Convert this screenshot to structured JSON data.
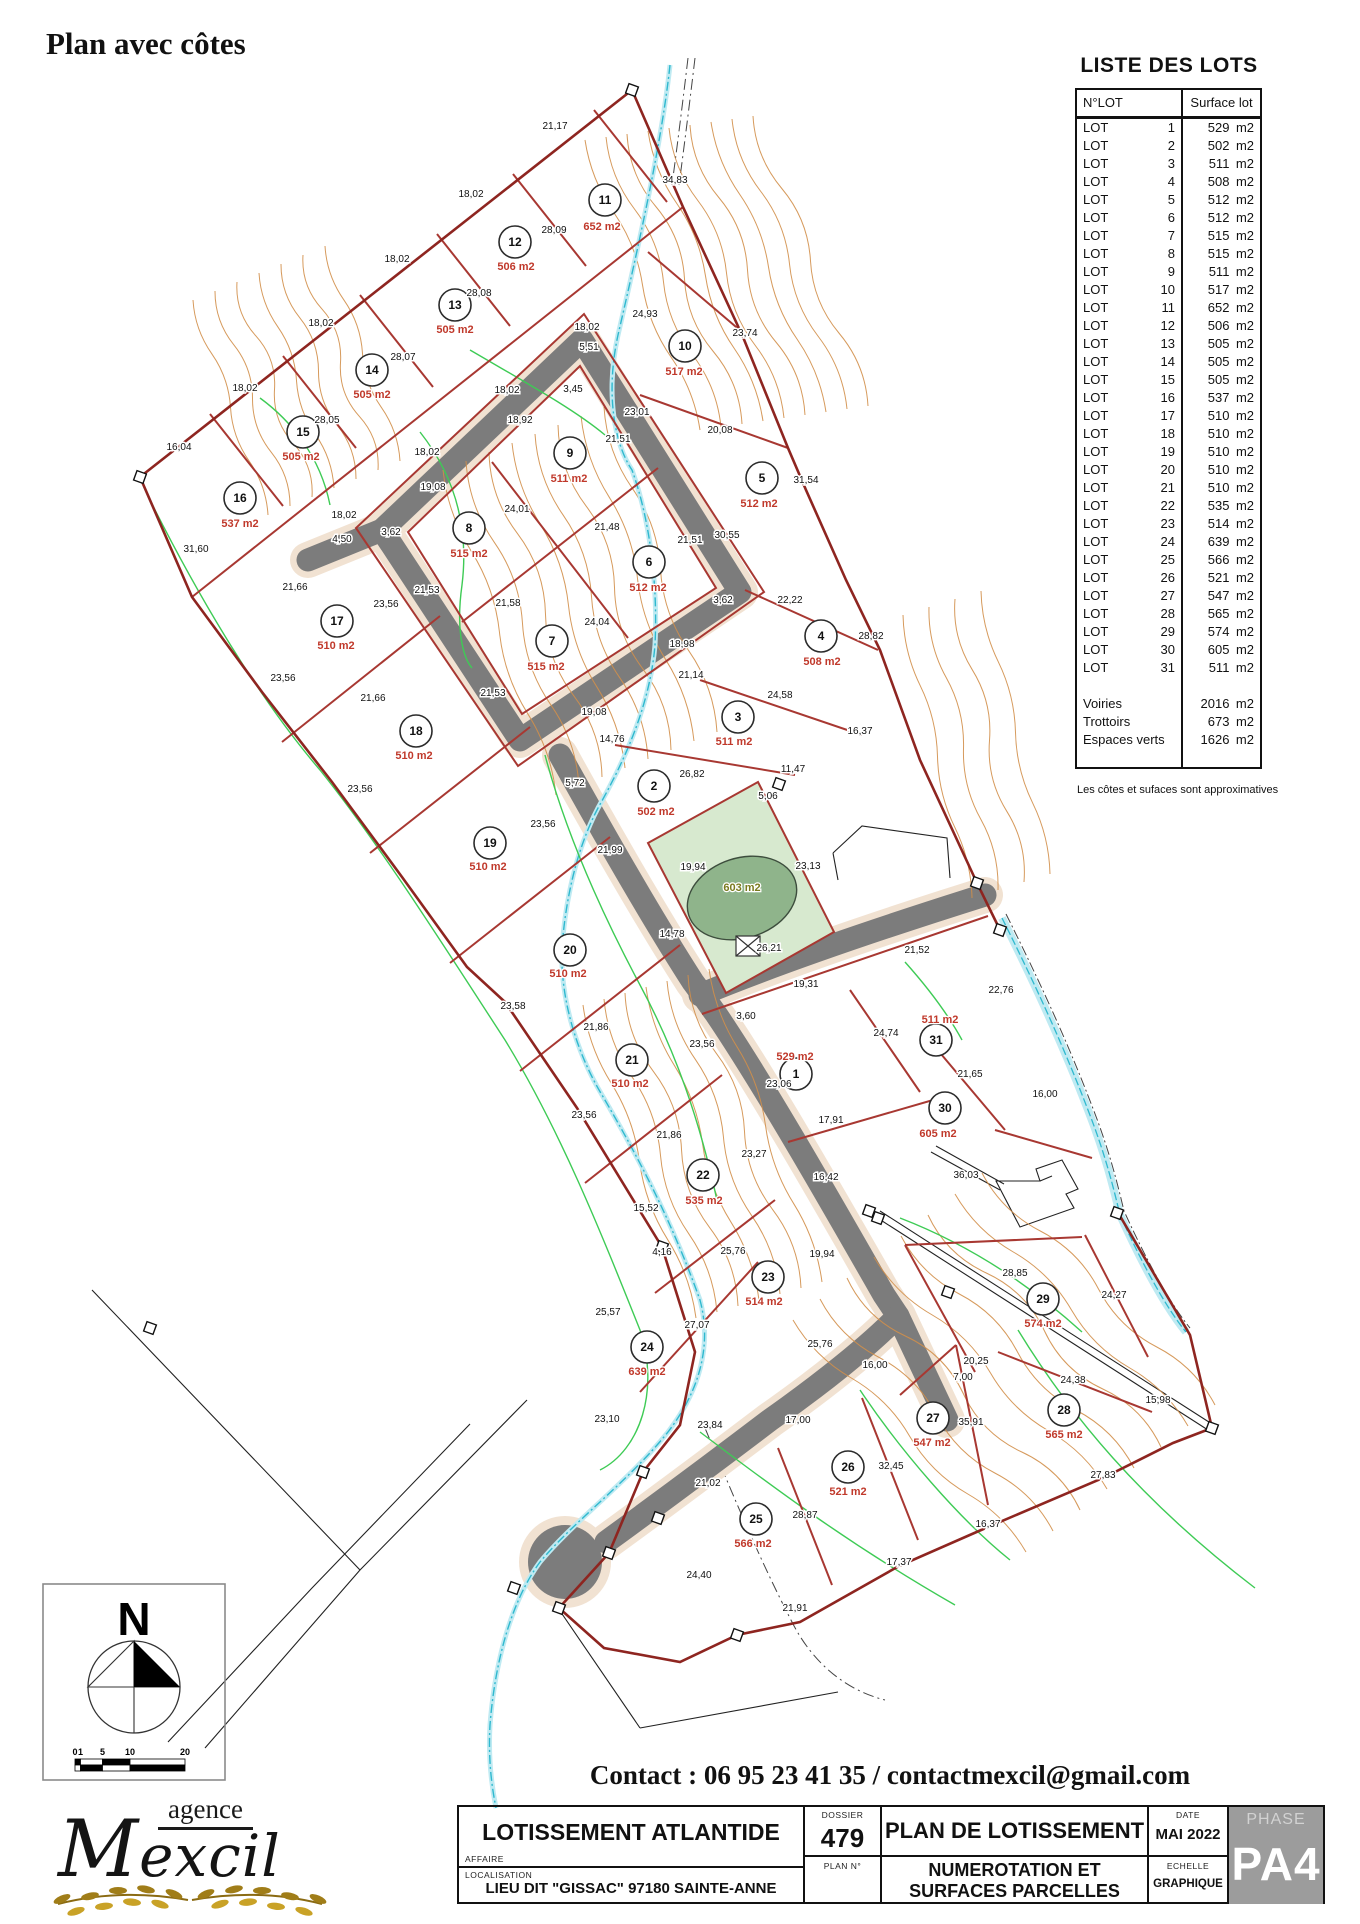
{
  "page": {
    "title": "Plan avec côtes",
    "contact": "Contact : 06 95 23 41 35 / contactmexcil@gmail.com",
    "note": "Les côtes et sufaces sont approximatives"
  },
  "lots_table": {
    "title": "LISTE DES LOTS",
    "col1": "N°LOT",
    "col2": "Surface lot",
    "unit": "m2",
    "rows": [
      {
        "l": "LOT",
        "n": "1",
        "v": "529"
      },
      {
        "l": "LOT",
        "n": "2",
        "v": "502"
      },
      {
        "l": "LOT",
        "n": "3",
        "v": "511"
      },
      {
        "l": "LOT",
        "n": "4",
        "v": "508"
      },
      {
        "l": "LOT",
        "n": "5",
        "v": "512"
      },
      {
        "l": "LOT",
        "n": "6",
        "v": "512"
      },
      {
        "l": "LOT",
        "n": "7",
        "v": "515"
      },
      {
        "l": "LOT",
        "n": "8",
        "v": "515"
      },
      {
        "l": "LOT",
        "n": "9",
        "v": "511"
      },
      {
        "l": "LOT",
        "n": "10",
        "v": "517"
      },
      {
        "l": "LOT",
        "n": "11",
        "v": "652"
      },
      {
        "l": "LOT",
        "n": "12",
        "v": "506"
      },
      {
        "l": "LOT",
        "n": "13",
        "v": "505"
      },
      {
        "l": "LOT",
        "n": "14",
        "v": "505"
      },
      {
        "l": "LOT",
        "n": "15",
        "v": "505"
      },
      {
        "l": "LOT",
        "n": "16",
        "v": "537"
      },
      {
        "l": "LOT",
        "n": "17",
        "v": "510"
      },
      {
        "l": "LOT",
        "n": "18",
        "v": "510"
      },
      {
        "l": "LOT",
        "n": "19",
        "v": "510"
      },
      {
        "l": "LOT",
        "n": "20",
        "v": "510"
      },
      {
        "l": "LOT",
        "n": "21",
        "v": "510"
      },
      {
        "l": "LOT",
        "n": "22",
        "v": "535"
      },
      {
        "l": "LOT",
        "n": "23",
        "v": "514"
      },
      {
        "l": "LOT",
        "n": "24",
        "v": "639"
      },
      {
        "l": "LOT",
        "n": "25",
        "v": "566"
      },
      {
        "l": "LOT",
        "n": "26",
        "v": "521"
      },
      {
        "l": "LOT",
        "n": "27",
        "v": "547"
      },
      {
        "l": "LOT",
        "n": "28",
        "v": "565"
      },
      {
        "l": "LOT",
        "n": "29",
        "v": "574"
      },
      {
        "l": "LOT",
        "n": "30",
        "v": "605"
      },
      {
        "l": "LOT",
        "n": "31",
        "v": "511"
      },
      {
        "gap": true
      },
      {
        "l": "Voiries",
        "v": "2016"
      },
      {
        "l": "Trottoirs",
        "v": "673"
      },
      {
        "l": "Espaces verts",
        "v": "1626"
      },
      {
        "gap": true
      }
    ]
  },
  "map": {
    "green_area_label": "603 m2",
    "colors": {
      "lot_line": "#a83832",
      "boundary": "#8e2520",
      "road": "#7c7c7c",
      "sidewalk": "#f1e2d2",
      "contour": "#d28f4a",
      "vegetation": "#3ecb55",
      "water": "#2fb9cf",
      "area_text": "#c0392b",
      "green_fill": "#d7e9cf",
      "pond": "#8fb48b",
      "phase_bg": "#9c9c9c"
    },
    "lots": [
      {
        "n": "1",
        "x": 796,
        "y": 1074,
        "lx": 795,
        "ly": 1052,
        "a": "529 m2"
      },
      {
        "n": "2",
        "x": 654,
        "y": 786,
        "lx": 656,
        "ly": 807,
        "a": "502 m2"
      },
      {
        "n": "3",
        "x": 738,
        "y": 717,
        "lx": 734,
        "ly": 737,
        "a": "511 m2"
      },
      {
        "n": "4",
        "x": 821,
        "y": 636,
        "lx": 822,
        "ly": 657,
        "a": "508 m2"
      },
      {
        "n": "5",
        "x": 762,
        "y": 478,
        "lx": 759,
        "ly": 499,
        "a": "512 m2"
      },
      {
        "n": "6",
        "x": 649,
        "y": 562,
        "lx": 648,
        "ly": 583,
        "a": "512 m2"
      },
      {
        "n": "7",
        "x": 552,
        "y": 641,
        "lx": 546,
        "ly": 662,
        "a": "515 m2"
      },
      {
        "n": "8",
        "x": 469,
        "y": 528,
        "lx": 469,
        "ly": 549,
        "a": "515 m2"
      },
      {
        "n": "9",
        "x": 570,
        "y": 453,
        "lx": 569,
        "ly": 474,
        "a": "511 m2"
      },
      {
        "n": "10",
        "x": 685,
        "y": 346,
        "lx": 684,
        "ly": 367,
        "a": "517 m2"
      },
      {
        "n": "11",
        "x": 605,
        "y": 200,
        "lx": 602,
        "ly": 222,
        "a": "652 m2"
      },
      {
        "n": "12",
        "x": 515,
        "y": 242,
        "lx": 516,
        "ly": 262,
        "a": "506 m2"
      },
      {
        "n": "13",
        "x": 455,
        "y": 305,
        "lx": 455,
        "ly": 325,
        "a": "505 m2"
      },
      {
        "n": "14",
        "x": 372,
        "y": 370,
        "lx": 372,
        "ly": 390,
        "a": "505 m2"
      },
      {
        "n": "15",
        "x": 303,
        "y": 432,
        "lx": 301,
        "ly": 452,
        "a": "505 m2"
      },
      {
        "n": "16",
        "x": 240,
        "y": 498,
        "lx": 240,
        "ly": 519,
        "a": "537 m2"
      },
      {
        "n": "17",
        "x": 337,
        "y": 621,
        "lx": 336,
        "ly": 641,
        "a": "510 m2"
      },
      {
        "n": "18",
        "x": 416,
        "y": 731,
        "lx": 414,
        "ly": 751,
        "a": "510 m2"
      },
      {
        "n": "19",
        "x": 490,
        "y": 843,
        "lx": 488,
        "ly": 862,
        "a": "510 m2"
      },
      {
        "n": "20",
        "x": 570,
        "y": 950,
        "lx": 568,
        "ly": 969,
        "a": "510 m2"
      },
      {
        "n": "21",
        "x": 632,
        "y": 1060,
        "lx": 630,
        "ly": 1079,
        "a": "510 m2"
      },
      {
        "n": "22",
        "x": 703,
        "y": 1175,
        "lx": 704,
        "ly": 1196,
        "a": "535 m2"
      },
      {
        "n": "23",
        "x": 768,
        "y": 1277,
        "lx": 764,
        "ly": 1297,
        "a": "514 m2"
      },
      {
        "n": "24",
        "x": 647,
        "y": 1347,
        "lx": 647,
        "ly": 1367,
        "a": "639 m2"
      },
      {
        "n": "25",
        "x": 756,
        "y": 1519,
        "lx": 753,
        "ly": 1539,
        "a": "566 m2"
      },
      {
        "n": "26",
        "x": 848,
        "y": 1467,
        "lx": 848,
        "ly": 1487,
        "a": "521 m2"
      },
      {
        "n": "27",
        "x": 933,
        "y": 1418,
        "lx": 932,
        "ly": 1438,
        "a": "547 m2"
      },
      {
        "n": "28",
        "x": 1064,
        "y": 1410,
        "lx": 1064,
        "ly": 1430,
        "a": "565 m2"
      },
      {
        "n": "29",
        "x": 1043,
        "y": 1299,
        "lx": 1043,
        "ly": 1319,
        "a": "574 m2"
      },
      {
        "n": "30",
        "x": 945,
        "y": 1108,
        "lx": 938,
        "ly": 1129,
        "a": "605 m2"
      },
      {
        "n": "31",
        "x": 936,
        "y": 1040,
        "lx": 940,
        "ly": 1015,
        "a": "511 m2"
      }
    ],
    "dims": [
      [
        "21,17",
        555,
        129
      ],
      [
        "34,83",
        675,
        183
      ],
      [
        "18,02",
        471,
        197
      ],
      [
        "28,09",
        554,
        233
      ],
      [
        "18,02",
        397,
        262
      ],
      [
        "28,08",
        479,
        296
      ],
      [
        "18,02",
        321,
        326
      ],
      [
        "28,07",
        403,
        360
      ],
      [
        "18,02",
        245,
        391
      ],
      [
        "28,05",
        327,
        423
      ],
      [
        "16,04",
        179,
        450
      ],
      [
        "31,60",
        196,
        552
      ],
      [
        "24,93",
        645,
        317
      ],
      [
        "23,74",
        745,
        336
      ],
      [
        "31,54",
        806,
        483
      ],
      [
        "23,01",
        637,
        415
      ],
      [
        "21,51",
        618,
        442
      ],
      [
        "20,08",
        720,
        433
      ],
      [
        "18,02",
        587,
        330
      ],
      [
        "5,51",
        589,
        350
      ],
      [
        "18,02",
        507,
        393
      ],
      [
        "18,92",
        520,
        423
      ],
      [
        "3,45",
        573,
        392
      ],
      [
        "19,08",
        433,
        490
      ],
      [
        "24,01",
        517,
        512
      ],
      [
        "18,02",
        427,
        455
      ],
      [
        "18,02",
        344,
        518
      ],
      [
        "4,50",
        342,
        542
      ],
      [
        "3,62",
        391,
        535
      ],
      [
        "21,53",
        427,
        593
      ],
      [
        "23,56",
        386,
        607
      ],
      [
        "21,58",
        508,
        606
      ],
      [
        "21,48",
        607,
        530
      ],
      [
        "21,51",
        690,
        543
      ],
      [
        "30,55",
        727,
        538
      ],
      [
        "3,62",
        723,
        603
      ],
      [
        "24,04",
        597,
        625
      ],
      [
        "18,98",
        682,
        647
      ],
      [
        "22,22",
        790,
        603
      ],
      [
        "28,82",
        871,
        639
      ],
      [
        "21,14",
        691,
        678
      ],
      [
        "24,58",
        780,
        698
      ],
      [
        "19,08",
        594,
        715
      ],
      [
        "16,37",
        860,
        734
      ],
      [
        "14,76",
        612,
        742
      ],
      [
        "11,47",
        793,
        772
      ],
      [
        "26,82",
        692,
        777
      ],
      [
        "5,06",
        768,
        799
      ],
      [
        "5,72",
        575,
        786
      ],
      [
        "23,56",
        543,
        827
      ],
      [
        "21,99",
        610,
        853
      ],
      [
        "19,94",
        693,
        870
      ],
      [
        "23,13",
        808,
        869
      ],
      [
        "21,53",
        493,
        696
      ],
      [
        "21,66",
        295,
        590
      ],
      [
        "21,66",
        373,
        701
      ],
      [
        "23,56",
        283,
        681
      ],
      [
        "23,56",
        360,
        792
      ],
      [
        "14,78",
        672,
        937
      ],
      [
        "26,21",
        769,
        951
      ],
      [
        "21,52",
        917,
        953
      ],
      [
        "19,31",
        806,
        987
      ],
      [
        "3,60",
        746,
        1019
      ],
      [
        "23,56",
        702,
        1047
      ],
      [
        "22,76",
        1001,
        993
      ],
      [
        "24,74",
        886,
        1036
      ],
      [
        "21,65",
        970,
        1077
      ],
      [
        "16,00",
        1045,
        1097
      ],
      [
        "23,06",
        779,
        1087
      ],
      [
        "23,58",
        513,
        1009
      ],
      [
        "21,86",
        596,
        1030
      ],
      [
        "17,91",
        831,
        1123
      ],
      [
        "23,27",
        754,
        1157
      ],
      [
        "23,56",
        584,
        1118
      ],
      [
        "21,86",
        669,
        1138
      ],
      [
        "16,42",
        826,
        1180
      ],
      [
        "15,52",
        646,
        1211
      ],
      [
        "4,16",
        662,
        1255
      ],
      [
        "25,76",
        733,
        1254
      ],
      [
        "19,94",
        822,
        1257
      ],
      [
        "25,57",
        608,
        1315
      ],
      [
        "27,07",
        697,
        1328
      ],
      [
        "36,03",
        966,
        1178
      ],
      [
        "28,85",
        1015,
        1276
      ],
      [
        "24,27",
        1114,
        1298
      ],
      [
        "25,76",
        820,
        1347
      ],
      [
        "16,00",
        875,
        1368
      ],
      [
        "20,25",
        976,
        1364
      ],
      [
        "7,00",
        963,
        1380
      ],
      [
        "24,38",
        1073,
        1383
      ],
      [
        "15,98",
        1158,
        1403
      ],
      [
        "35,91",
        971,
        1425
      ],
      [
        "32,45",
        891,
        1469
      ],
      [
        "27,83",
        1103,
        1478
      ],
      [
        "16,37",
        988,
        1527
      ],
      [
        "17,37",
        899,
        1565
      ],
      [
        "28,87",
        805,
        1518
      ],
      [
        "17,00",
        798,
        1423
      ],
      [
        "23,84",
        710,
        1428
      ],
      [
        "23,10",
        607,
        1422
      ],
      [
        "21,02",
        708,
        1486
      ],
      [
        "24,40",
        699,
        1578
      ],
      [
        "21,91",
        795,
        1611
      ]
    ]
  },
  "compass": {
    "label": "N",
    "scale_ticks": [
      "0",
      "1",
      "5",
      "10",
      "20"
    ]
  },
  "logo": {
    "line1": "agence",
    "line2": "Mexcil"
  },
  "title_block": {
    "affaire_label": "AFFAIRE",
    "affaire": "LOTISSEMENT ATLANTIDE",
    "localisation_label": "LOCALISATION",
    "localisation": "LIEU DIT \"GISSAC\" 97180 SAINTE-ANNE",
    "dossier_label": "DOSSIER",
    "dossier": "479",
    "plan_no_label": "PLAN N°",
    "plan_title": "PLAN DE LOTISSEMENT",
    "subtitle_line1": "NUMEROTATION ET",
    "subtitle_line2": "SURFACES PARCELLES",
    "date_label": "DATE",
    "date": "MAI 2022",
    "echelle_label": "ECHELLE",
    "echelle": "GRAPHIQUE",
    "phase_label": "PHASE",
    "phase": "PA4"
  }
}
